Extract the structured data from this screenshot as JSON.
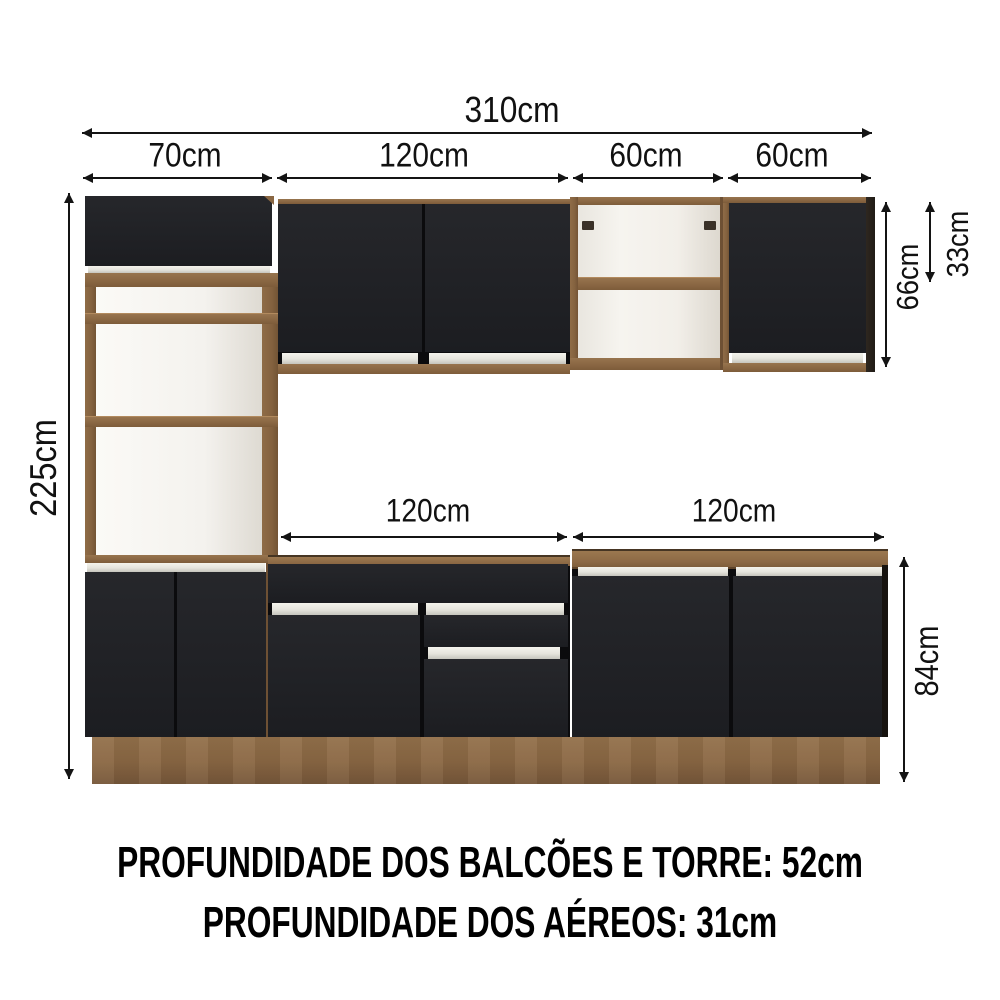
{
  "annotations": {
    "total_width": "310cm",
    "sections": [
      "70cm",
      "120cm",
      "60cm",
      "60cm"
    ],
    "total_height": "225cm",
    "niche_top": "15cm",
    "niche_middle": "37cm",
    "niche_bottom": "54cm",
    "uppers_height": "66cm",
    "uppers_half_height": "33cm",
    "counters": [
      "120cm",
      "120cm"
    ],
    "base_height": "84cm"
  },
  "footer": {
    "line1": "PROFUNDIDADE DOS BALCÕES E TORRE: 52cm",
    "line2": "PROFUNDIDADE DOS AÉREOS: 31cm"
  },
  "colors": {
    "wood": "#8c6a46",
    "door_black": "#222327",
    "handle_silver": "#e9e8e0",
    "annotation": "#141414",
    "background": "#ffffff"
  }
}
